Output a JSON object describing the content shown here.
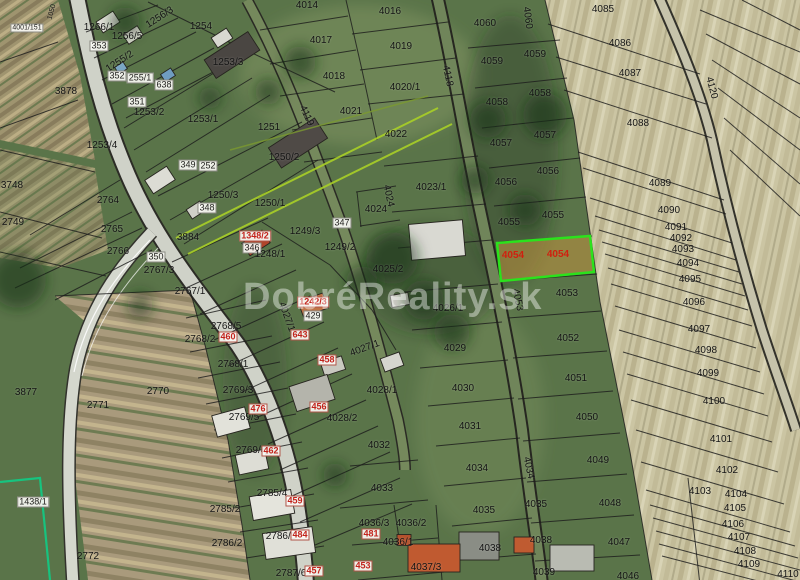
{
  "watermark": {
    "text": "DobréReality.sk"
  },
  "highlight": {
    "parcel": "4054",
    "border_color": "#2be21c",
    "fill_color": "#c1923e",
    "fill_opacity": 0.55,
    "label_color": "#d0200f"
  },
  "colors": {
    "boundary_line": "#1c1c1c",
    "survey_green_line": "#a8cf27",
    "survey_teal_line": "#17c37f",
    "red_label": "#c3231c"
  },
  "labels": [
    {
      "t": "1050",
      "x": 52,
      "y": 12,
      "r": -75,
      "s": 7
    },
    {
      "t": "4001/151",
      "x": 27,
      "y": 28,
      "k": "b",
      "s": 7
    },
    {
      "t": "1266/1",
      "x": 99,
      "y": 28
    },
    {
      "t": "1256/3",
      "x": 160,
      "y": 18,
      "r": -33
    },
    {
      "t": "1256/5",
      "x": 127,
      "y": 37
    },
    {
      "t": "353",
      "x": 99,
      "y": 46,
      "k": "b"
    },
    {
      "t": "1254",
      "x": 201,
      "y": 27
    },
    {
      "t": "1253/3",
      "x": 228,
      "y": 63
    },
    {
      "t": "1255/2",
      "x": 120,
      "y": 62,
      "r": -33
    },
    {
      "t": "352",
      "x": 117,
      "y": 76,
      "k": "b"
    },
    {
      "t": "255/1",
      "x": 140,
      "y": 78,
      "k": "b"
    },
    {
      "t": "638",
      "x": 164,
      "y": 85,
      "k": "b"
    },
    {
      "t": "351",
      "x": 137,
      "y": 102,
      "k": "b"
    },
    {
      "t": "1253/2",
      "x": 149,
      "y": 113
    },
    {
      "t": "1253/1",
      "x": 203,
      "y": 120
    },
    {
      "t": "1251",
      "x": 269,
      "y": 128
    },
    {
      "t": "3878",
      "x": 66,
      "y": 92
    },
    {
      "t": "1253/4",
      "x": 102,
      "y": 146
    },
    {
      "t": "1250/2",
      "x": 284,
      "y": 158
    },
    {
      "t": "349",
      "x": 188,
      "y": 165,
      "k": "b"
    },
    {
      "t": "252",
      "x": 208,
      "y": 166,
      "k": "b"
    },
    {
      "t": "1250/3",
      "x": 223,
      "y": 196
    },
    {
      "t": "1250/1",
      "x": 270,
      "y": 204
    },
    {
      "t": "348",
      "x": 207,
      "y": 208,
      "k": "b"
    },
    {
      "t": "346",
      "x": 252,
      "y": 248,
      "k": "b"
    },
    {
      "t": "1348/2",
      "x": 255,
      "y": 236,
      "k": "r"
    },
    {
      "t": "1249/3",
      "x": 305,
      "y": 232
    },
    {
      "t": "347",
      "x": 342,
      "y": 223,
      "k": "b"
    },
    {
      "t": "1249/2",
      "x": 340,
      "y": 248
    },
    {
      "t": "1248/1",
      "x": 270,
      "y": 255
    },
    {
      "t": "3884",
      "x": 188,
      "y": 238
    },
    {
      "t": "350",
      "x": 156,
      "y": 257,
      "k": "b"
    },
    {
      "t": "2767/3",
      "x": 159,
      "y": 271
    },
    {
      "t": "2767/1",
      "x": 190,
      "y": 292
    },
    {
      "t": "2764",
      "x": 108,
      "y": 201
    },
    {
      "t": "2765",
      "x": 112,
      "y": 230
    },
    {
      "t": "2766",
      "x": 118,
      "y": 252
    },
    {
      "t": "2749",
      "x": 13,
      "y": 223
    },
    {
      "t": "3748",
      "x": 12,
      "y": 186
    },
    {
      "t": "3877",
      "x": 26,
      "y": 393
    },
    {
      "t": "2771",
      "x": 98,
      "y": 406
    },
    {
      "t": "2770",
      "x": 158,
      "y": 392
    },
    {
      "t": "2772",
      "x": 88,
      "y": 557
    },
    {
      "t": "1438/1",
      "x": 33,
      "y": 502,
      "k": "b"
    },
    {
      "t": "2768/5",
      "x": 226,
      "y": 327
    },
    {
      "t": "460",
      "x": 228,
      "y": 337,
      "k": "r"
    },
    {
      "t": "2768/2",
      "x": 200,
      "y": 340
    },
    {
      "t": "2768/1",
      "x": 233,
      "y": 365
    },
    {
      "t": "2769/3",
      "x": 238,
      "y": 391
    },
    {
      "t": "2769/5",
      "x": 244,
      "y": 418
    },
    {
      "t": "476",
      "x": 258,
      "y": 409,
      "k": "r"
    },
    {
      "t": "2769/4",
      "x": 251,
      "y": 451
    },
    {
      "t": "462",
      "x": 271,
      "y": 451,
      "k": "r"
    },
    {
      "t": "2785/4",
      "x": 272,
      "y": 494
    },
    {
      "t": "459",
      "x": 295,
      "y": 501,
      "k": "r"
    },
    {
      "t": "2785/2",
      "x": 225,
      "y": 510
    },
    {
      "t": "2786/2",
      "x": 227,
      "y": 544
    },
    {
      "t": "2786/3",
      "x": 281,
      "y": 537
    },
    {
      "t": "484",
      "x": 300,
      "y": 535,
      "k": "r"
    },
    {
      "t": "2787/6",
      "x": 291,
      "y": 574
    },
    {
      "t": "457",
      "x": 314,
      "y": 571,
      "k": "r"
    },
    {
      "t": "643",
      "x": 300,
      "y": 335,
      "k": "r"
    },
    {
      "t": "458",
      "x": 327,
      "y": 360,
      "k": "r"
    },
    {
      "t": "456",
      "x": 319,
      "y": 407,
      "k": "r"
    },
    {
      "t": "1242/3",
      "x": 313,
      "y": 302,
      "k": "r"
    },
    {
      "t": "429",
      "x": 313,
      "y": 316,
      "k": "b"
    },
    {
      "t": "4014",
      "x": 307,
      "y": 6
    },
    {
      "t": "4016",
      "x": 390,
      "y": 12
    },
    {
      "t": "4017",
      "x": 321,
      "y": 41
    },
    {
      "t": "4019",
      "x": 401,
      "y": 47
    },
    {
      "t": "4018",
      "x": 334,
      "y": 77
    },
    {
      "t": "4020/1",
      "x": 405,
      "y": 88
    },
    {
      "t": "4021",
      "x": 351,
      "y": 112
    },
    {
      "t": "4022",
      "x": 396,
      "y": 135
    },
    {
      "t": "4118",
      "x": 447,
      "y": 76,
      "r": 78
    },
    {
      "t": "4119",
      "x": 306,
      "y": 116,
      "r": 65
    },
    {
      "t": "4023/1",
      "x": 431,
      "y": 188
    },
    {
      "t": "4024",
      "x": 376,
      "y": 210
    },
    {
      "t": "4024",
      "x": 388,
      "y": 196,
      "r": 78
    },
    {
      "t": "4025/2",
      "x": 388,
      "y": 270
    },
    {
      "t": "4026/1",
      "x": 448,
      "y": 309
    },
    {
      "t": "4027/1",
      "x": 365,
      "y": 349,
      "r": -20
    },
    {
      "t": "4027/1",
      "x": 286,
      "y": 317,
      "r": 70
    },
    {
      "t": "4028/1",
      "x": 382,
      "y": 391
    },
    {
      "t": "4028/2",
      "x": 342,
      "y": 419
    },
    {
      "t": "4029",
      "x": 455,
      "y": 349
    },
    {
      "t": "4030",
      "x": 463,
      "y": 389
    },
    {
      "t": "4031",
      "x": 470,
      "y": 427
    },
    {
      "t": "4032",
      "x": 379,
      "y": 446
    },
    {
      "t": "4033",
      "x": 382,
      "y": 489
    },
    {
      "t": "4034",
      "x": 477,
      "y": 469
    },
    {
      "t": "4034",
      "x": 528,
      "y": 468,
      "r": 78
    },
    {
      "t": "4035",
      "x": 484,
      "y": 511
    },
    {
      "t": "4035",
      "x": 536,
      "y": 505
    },
    {
      "t": "4036/3",
      "x": 374,
      "y": 524
    },
    {
      "t": "481",
      "x": 371,
      "y": 534,
      "k": "r"
    },
    {
      "t": "4036/2",
      "x": 411,
      "y": 524
    },
    {
      "t": "4036/1",
      "x": 398,
      "y": 543
    },
    {
      "t": "453",
      "x": 363,
      "y": 566,
      "k": "r"
    },
    {
      "t": "4037/3",
      "x": 426,
      "y": 568
    },
    {
      "t": "4038",
      "x": 490,
      "y": 549
    },
    {
      "t": "4038",
      "x": 541,
      "y": 541
    },
    {
      "t": "4039",
      "x": 544,
      "y": 573
    },
    {
      "t": "4046",
      "x": 628,
      "y": 577
    },
    {
      "t": "4047",
      "x": 619,
      "y": 543
    },
    {
      "t": "4048",
      "x": 610,
      "y": 504
    },
    {
      "t": "4049",
      "x": 598,
      "y": 461
    },
    {
      "t": "4050",
      "x": 587,
      "y": 418
    },
    {
      "t": "4051",
      "x": 576,
      "y": 379
    },
    {
      "t": "4052",
      "x": 568,
      "y": 339
    },
    {
      "t": "4053",
      "x": 567,
      "y": 294
    },
    {
      "t": "4053",
      "x": 517,
      "y": 300,
      "r": 78
    },
    {
      "t": "4054",
      "x": 513,
      "y": 256,
      "k": "h"
    },
    {
      "t": "4054",
      "x": 558,
      "y": 255,
      "k": "h"
    },
    {
      "t": "4055",
      "x": 553,
      "y": 216
    },
    {
      "t": "4055",
      "x": 509,
      "y": 223
    },
    {
      "t": "4056",
      "x": 548,
      "y": 172
    },
    {
      "t": "4056",
      "x": 506,
      "y": 183
    },
    {
      "t": "4057",
      "x": 545,
      "y": 136
    },
    {
      "t": "4057",
      "x": 501,
      "y": 144
    },
    {
      "t": "4058",
      "x": 540,
      "y": 94
    },
    {
      "t": "4058",
      "x": 497,
      "y": 103
    },
    {
      "t": "4059",
      "x": 535,
      "y": 55
    },
    {
      "t": "4059",
      "x": 492,
      "y": 62
    },
    {
      "t": "4060",
      "x": 485,
      "y": 24
    },
    {
      "t": "4060",
      "x": 527,
      "y": 18,
      "r": 82
    },
    {
      "t": "4085",
      "x": 603,
      "y": 10
    },
    {
      "t": "4086",
      "x": 620,
      "y": 44
    },
    {
      "t": "4087",
      "x": 630,
      "y": 74
    },
    {
      "t": "4088",
      "x": 638,
      "y": 124
    },
    {
      "t": "4089",
      "x": 660,
      "y": 184
    },
    {
      "t": "4090",
      "x": 669,
      "y": 211
    },
    {
      "t": "4091",
      "x": 676,
      "y": 228
    },
    {
      "t": "4092",
      "x": 681,
      "y": 239
    },
    {
      "t": "4093",
      "x": 683,
      "y": 250
    },
    {
      "t": "4094",
      "x": 688,
      "y": 264
    },
    {
      "t": "4095",
      "x": 690,
      "y": 280
    },
    {
      "t": "4096",
      "x": 694,
      "y": 303
    },
    {
      "t": "4097",
      "x": 699,
      "y": 330
    },
    {
      "t": "4098",
      "x": 706,
      "y": 351
    },
    {
      "t": "4099",
      "x": 708,
      "y": 374
    },
    {
      "t": "4100",
      "x": 714,
      "y": 402
    },
    {
      "t": "4101",
      "x": 721,
      "y": 440
    },
    {
      "t": "4102",
      "x": 727,
      "y": 471
    },
    {
      "t": "4103",
      "x": 700,
      "y": 492
    },
    {
      "t": "4104",
      "x": 736,
      "y": 495
    },
    {
      "t": "4105",
      "x": 735,
      "y": 509
    },
    {
      "t": "4106",
      "x": 733,
      "y": 525
    },
    {
      "t": "4107",
      "x": 739,
      "y": 538
    },
    {
      "t": "4108",
      "x": 745,
      "y": 552
    },
    {
      "t": "4109",
      "x": 749,
      "y": 565
    },
    {
      "t": "4110",
      "x": 788,
      "y": 575
    },
    {
      "t": "4120",
      "x": 711,
      "y": 88,
      "r": 75
    }
  ]
}
